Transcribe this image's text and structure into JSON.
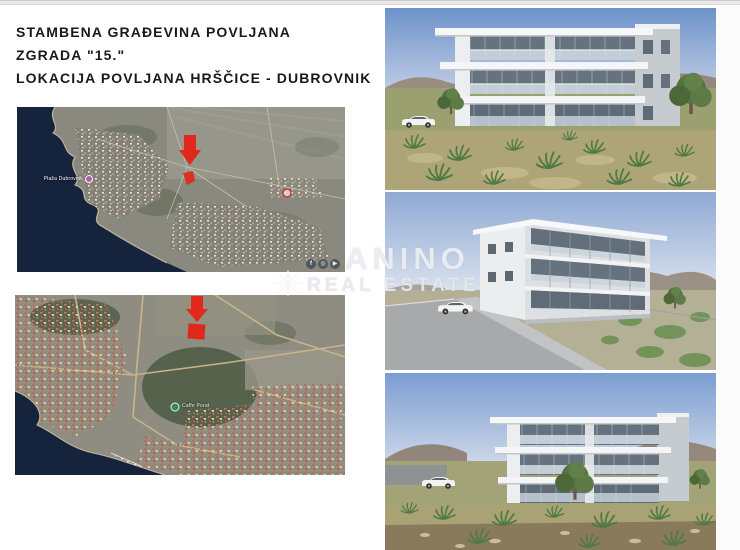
{
  "title": {
    "line1": "STAMBENA GRAĐEVINA POVLJANA",
    "line2": "ZGRADA \"15.\"",
    "line3": "LOKACIJA POVLJANA HRŠČICE - DUBROVNIK"
  },
  "maps": {
    "wide": {
      "beach_label": "Plaža Dubrovnik"
    },
    "close": {
      "cafe_label": "Caffe Porat"
    }
  },
  "watermark": {
    "name": "ANINO",
    "tagline": "REAL ESTATE",
    "social": [
      "f",
      "◎",
      "▶"
    ]
  },
  "icons": {
    "map_markers": [
      "red-arrow-down",
      "red-plot-rectangle",
      "purple-beach-marker",
      "red-poi-marker",
      "green-cafe-marker"
    ],
    "watermark_icons": [
      "facebook-icon",
      "instagram-icon",
      "youtube-icon",
      "snowflake-logo-icon"
    ]
  },
  "colors": {
    "accent_red": "#e0281c",
    "sea": "#16233c",
    "sky": "#7d9fd0",
    "title_text": "#191919",
    "land": "#8a897f"
  }
}
